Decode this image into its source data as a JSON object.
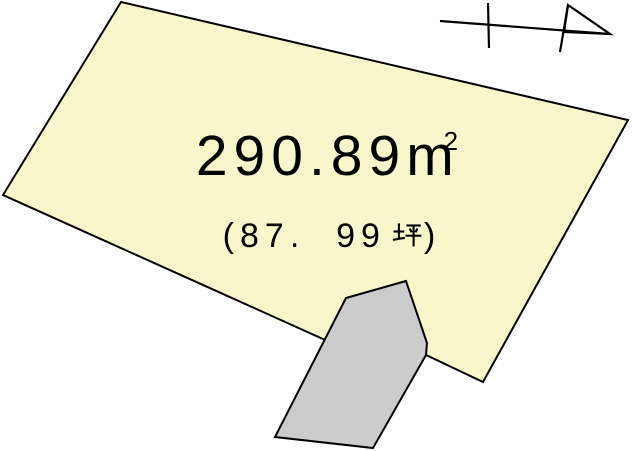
{
  "labels": {
    "area_value": "290.89",
    "area_unit_base": "m",
    "area_unit_sup": "2",
    "area_text_full": "290.89㎡",
    "tsubo_prefix": "(87.  99",
    "tsubo_kanji": "坪",
    "tsubo_suffix": ")",
    "tsubo_text_full": "(87.99坪)"
  },
  "colors": {
    "background": "#FFFFFF",
    "land_fill": "#FAF6CC",
    "building_fill": "#CCCCCC",
    "outline": "#000000",
    "text": "#000000"
  },
  "shapes": {
    "land_parcel": "121,2 628,120 483,382 426,355 323,339 3,195",
    "building": "346,298 406,281 427,343 426,355 373,448 275,437",
    "north_arrow_shaft": "440,21 610,34",
    "north_arrow_tick": "488,3 489,48",
    "north_arrow_pole": "568,5 560,52",
    "north_arrow_head": "568,5 610,34 564,32"
  }
}
